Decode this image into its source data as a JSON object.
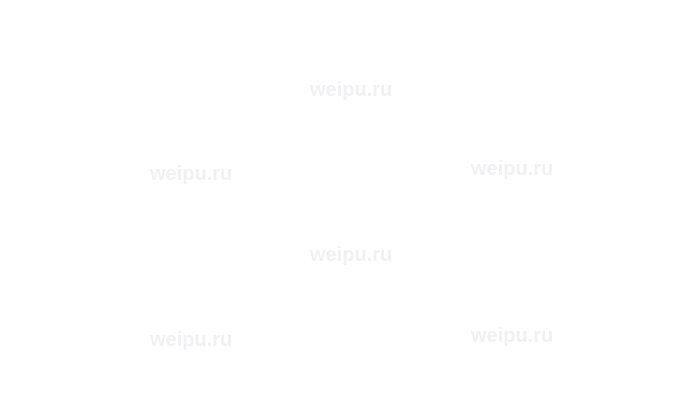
{
  "image": {
    "background_color": "#ffffff",
    "description": "blank watermarked image area"
  },
  "watermark": {
    "text": "weipu.ru",
    "color": "#f1f1f3",
    "count": 6
  }
}
